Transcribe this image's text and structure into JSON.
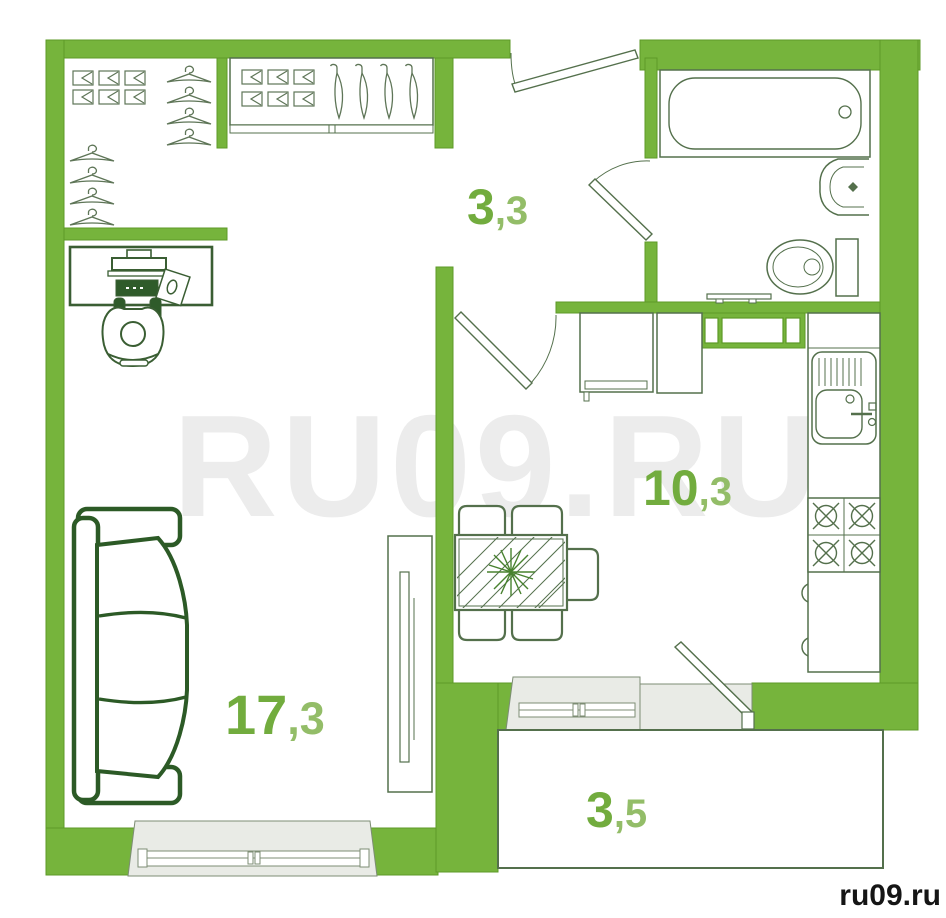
{
  "watermark": {
    "text": "RU09.RU",
    "credit": "ru09.ru"
  },
  "rooms": [
    {
      "id": "hallway",
      "area_main": "3",
      "area_sub": ",3"
    },
    {
      "id": "kitchen",
      "area_main": "10",
      "area_sub": ",3"
    },
    {
      "id": "living_room",
      "area_main": "17",
      "area_sub": ",3"
    },
    {
      "id": "balcony",
      "area_main": "3",
      "area_sub": ",5"
    }
  ],
  "colors": {
    "wall_green": "#76b43c",
    "wall_edge": "#5d9a27",
    "furniture_line": "#54704c",
    "sofa_green": "#2c5a26",
    "desk_green": "#3a5e33",
    "label_green": "#72ac3e",
    "label_green_light": "#93bd68",
    "watermark_gray": "#ececec",
    "credit_text": "#151515",
    "reveal_gray": "#e9ebe6",
    "dark_fill": "#2f5b2a"
  },
  "icons": {
    "bathtub": "bathtub-icon",
    "toilet": "toilet-icon",
    "washbasin": "washbasin-icon",
    "towel_rail": "towel-rail-icon",
    "kitchen_sink": "kitchen-sink-icon",
    "stove": "stove-icon",
    "fridge": "fridge-icon",
    "vent_shaft": "vent-shaft-icon",
    "dining_table": "dining-table-icon",
    "chair": "chair-icon",
    "sofa": "sofa-icon",
    "tv_stand": "tv-stand-icon",
    "wardrobe": "wardrobe-icon",
    "hanger": "hanger-icon",
    "folded_clothes": "folded-clothes-icon",
    "desk_person": "desk-person-icon",
    "door": "door-icon",
    "window": "window-icon"
  }
}
